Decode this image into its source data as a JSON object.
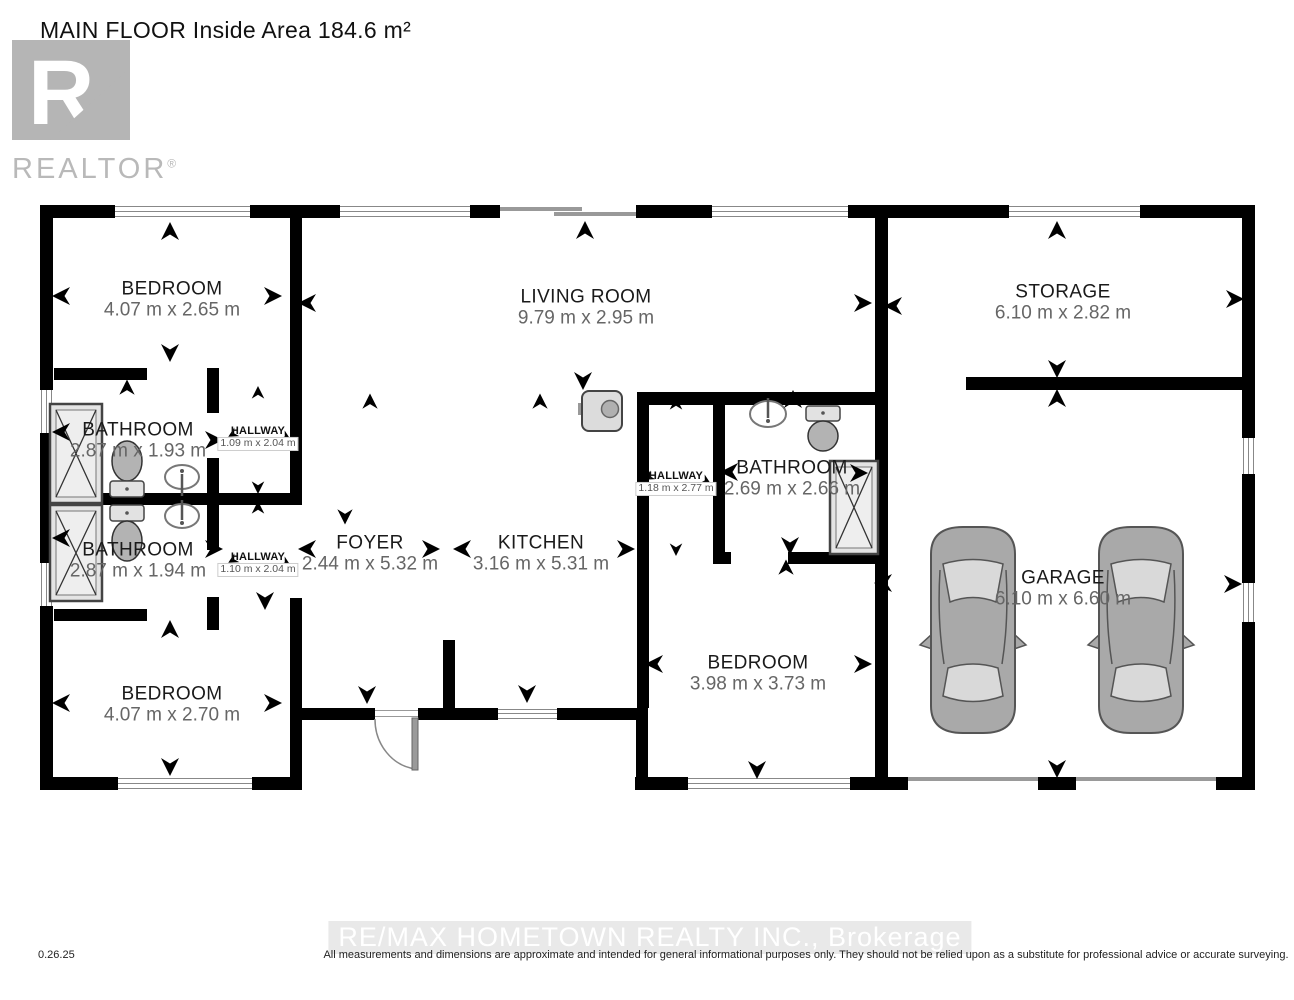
{
  "title": "MAIN FLOOR Inside Area 184.6 m²",
  "logo": {
    "letter": "R",
    "brand": "REALTOR",
    "registered": "®"
  },
  "rooms": [
    {
      "name": "BEDROOM",
      "dims": "4.07 m x 2.65 m"
    },
    {
      "name": "LIVING ROOM",
      "dims": "9.79 m x 2.95 m"
    },
    {
      "name": "STORAGE",
      "dims": "6.10 m x 2.82 m"
    },
    {
      "name": "BATHROOM",
      "dims": "2.87 m x 1.93 m"
    },
    {
      "name": "HALLWAY",
      "dims": "1.09 m x 2.04 m"
    },
    {
      "name": "BATHROOM",
      "dims": "2.87 m x 1.94 m"
    },
    {
      "name": "HALLWAY",
      "dims": "1.10 m x 2.04 m"
    },
    {
      "name": "FOYER",
      "dims": "2.44 m x 5.32 m"
    },
    {
      "name": "KITCHEN",
      "dims": "3.16 m x 5.31 m"
    },
    {
      "name": "HALLWAY",
      "dims": "1.18 m x 2.77 m"
    },
    {
      "name": "BATHROOM",
      "dims": "2.69 m x 2.66 m"
    },
    {
      "name": "GARAGE",
      "dims": "6.10 m x 6.60 m"
    },
    {
      "name": "BEDROOM",
      "dims": "4.07 m x 2.70 m"
    },
    {
      "name": "BEDROOM",
      "dims": "3.98 m x 3.73 m"
    }
  ],
  "footer": {
    "date": "0.26.25",
    "brokerage": "RE/MAX HOMETOWN REALTY INC., Brokerage",
    "disclaimer": "All measurements and dimensions are approximate and intended for general informational purposes only. They should not be relied upon as a substitute for professional advice or accurate surveying."
  },
  "colors": {
    "wall": "#000000",
    "room_text": "#1a1a1a",
    "dim_text": "#666666",
    "logo_gray": "#b5b5b5",
    "fixture_fill": "#e4e4e4",
    "car_body": "#a9a9a9",
    "footer_band": "#e9e9e9",
    "footer_text": "#ffffff"
  }
}
